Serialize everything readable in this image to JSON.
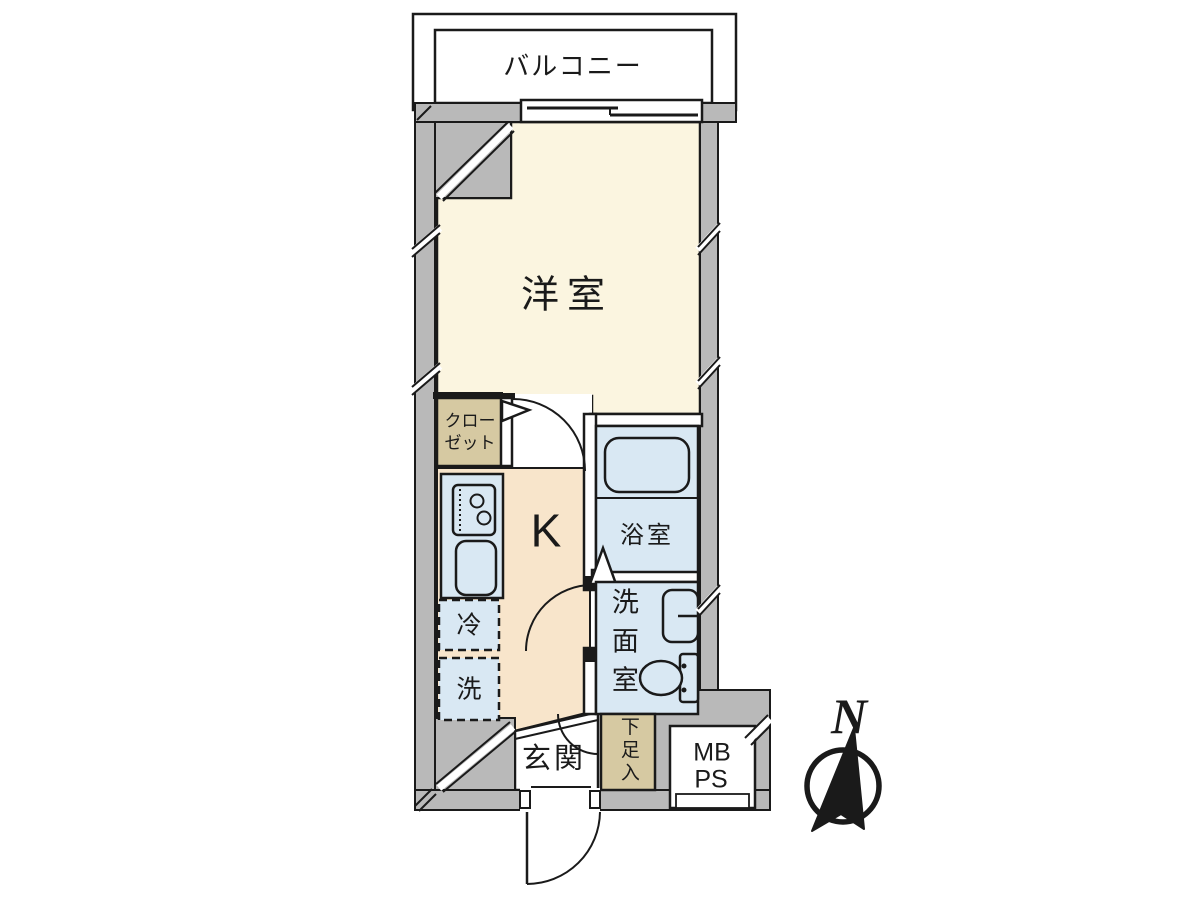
{
  "colors": {
    "wall": "#b9b9b9",
    "room": "#fbf5e0",
    "kitchen": "#f8e5cb",
    "water": "#d9e8f3",
    "storage": "#d6c9a2",
    "outline": "#1a1a1a"
  },
  "plan": {
    "balcony": {
      "label": "バルコニー"
    },
    "western_room": {
      "label": "洋室"
    },
    "kitchen": {
      "label": "K"
    },
    "closet": {
      "label_line1": "クロー",
      "label_line2": "ゼット"
    },
    "bathroom": {
      "label": "浴室"
    },
    "washroom": {
      "label": "洗面室"
    },
    "refrigerator_space": {
      "label": "冷"
    },
    "washer_space": {
      "label": "洗"
    },
    "entrance": {
      "label": "玄関"
    },
    "shoe_cabinet": {
      "label": "下足入"
    },
    "meter_box": {
      "label": "MB"
    },
    "pipe_space": {
      "label": "PS"
    }
  },
  "compass": {
    "north": "N"
  }
}
